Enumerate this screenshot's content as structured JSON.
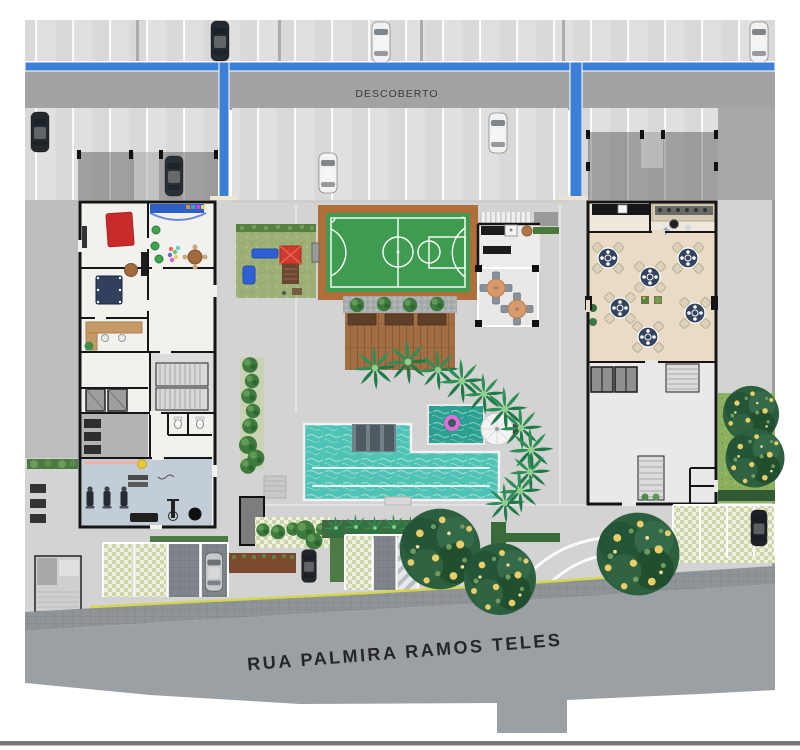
{
  "site_plan": {
    "labels": {
      "uncovered_parking": "DESCOBERTO",
      "street_name": "RUA PALMIRA RAMOS TELES"
    },
    "colors": {
      "driveway_line_blue": "#3c7fd8",
      "court_green": "#3f9b50",
      "court_border_terracotta": "#b06f3a",
      "pool_water": "#4fc3b5",
      "kids_pool_water": "#2ba092",
      "playground_grass": "#9cb077",
      "lawn_green": "#8bb05e",
      "street_gray": "#9ba0a5",
      "deck_wood_brown": "#a26f44",
      "party_room_floor": "#e9dbc6",
      "gym_floor": "#c3cdd8"
    },
    "inventory": {
      "cars_visible": 10,
      "party_room_tables": 6,
      "bbq_pergola_tables": 2,
      "flowering_trees": 5,
      "palm_trees": 16,
      "pools": 2,
      "parasols": 1,
      "sports_courts": 1
    }
  }
}
